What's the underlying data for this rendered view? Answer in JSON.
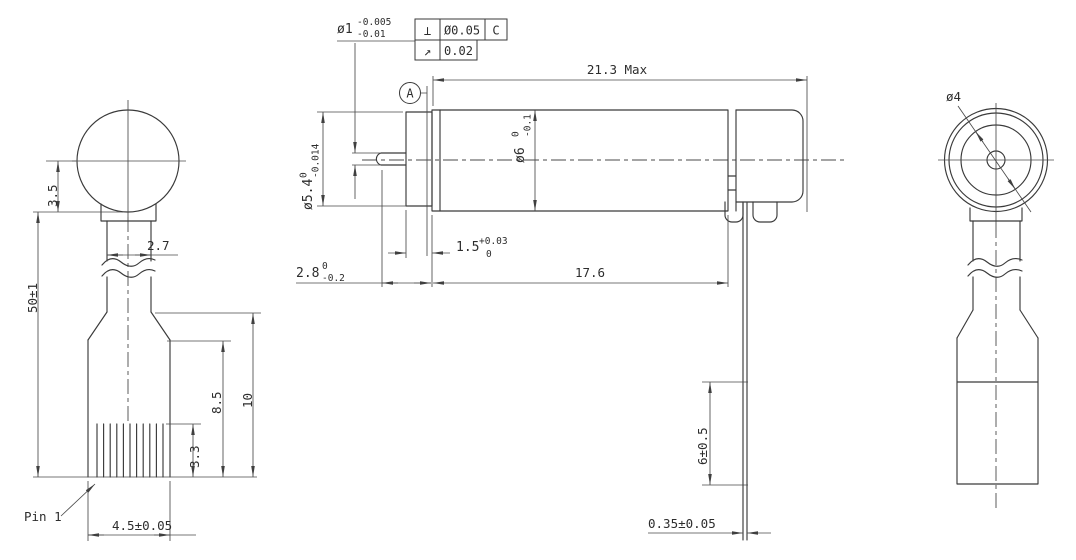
{
  "front_view": {
    "dim_center_to_shoulder": "3.5",
    "dim_shaft_width": "2.7",
    "dim_overall": "50±1",
    "dim_pins_to_taper": "8.5",
    "dim_bottom_to_taper": "10",
    "dim_pin_height": "3.3",
    "pin_label": "Pin 1",
    "dim_body_width": "4.5±0.05"
  },
  "side_view": {
    "shaft_dia": {
      "value": "ø1",
      "tol_upper": "-0.005",
      "tol_lower": "-0.01"
    },
    "fcf_perpendicularity": {
      "symbol": "⊥",
      "tolerance": "Ø0.05",
      "datum": "C"
    },
    "fcf_runout": {
      "symbol": "↗",
      "tolerance": "0.02"
    },
    "datum": "A",
    "dim_overall": "21.3 Max",
    "dim_body_dia": {
      "value": "ø6",
      "tol_upper": "0",
      "tol_lower": "-0.1"
    },
    "dim_boss_dia": {
      "value": "ø5.4",
      "tol_upper": "0",
      "tol_lower": "-0.014"
    },
    "dim_boss_len": {
      "value": "1.5",
      "tol_upper": "+0.03",
      "tol_lower": "0"
    },
    "dim_shaft_len": {
      "value": "2.8",
      "tol_upper": "0",
      "tol_lower": "-0.2"
    },
    "dim_body_len": "17.6",
    "dim_terminal_len": "6±0.5",
    "dim_terminal_thk": "0.35±0.05"
  },
  "end_view": {
    "dim_boss_dia": "ø4"
  }
}
